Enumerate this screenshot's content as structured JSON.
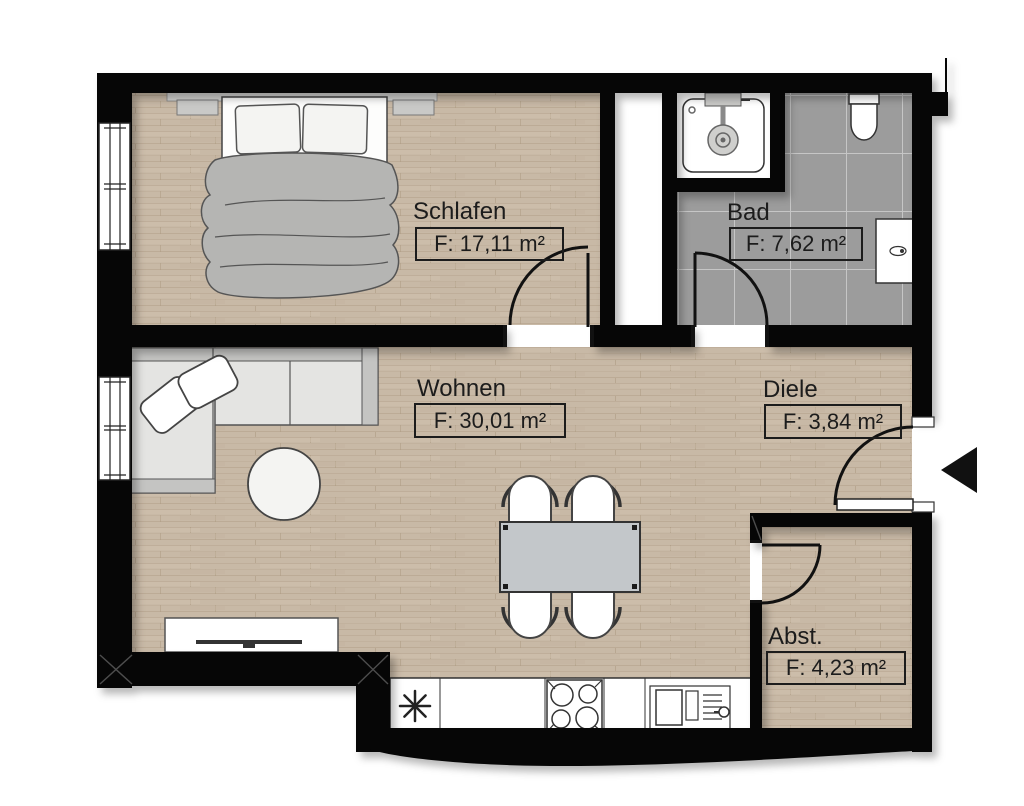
{
  "plan_type": "apartment-floor-plan",
  "rooms": [
    {
      "name": "Schlafen",
      "area_label": "F: 17,11 m²"
    },
    {
      "name": "Bad",
      "area_label": "F: 7,62 m²"
    },
    {
      "name": "Wohnen",
      "area_label": "F: 30,01 m²"
    },
    {
      "name": "Diele",
      "area_label": "F: 3,84 m²"
    },
    {
      "name": "Abst.",
      "area_label": "F: 4,23 m²"
    }
  ],
  "icons": {
    "entrance-arrow-icon": "◀",
    "freezer-asterisk-icon": "✳",
    "stove-icon": "4-burner-circles",
    "sink-icon": "basin-with-drainer",
    "shower-icon": "square-tray-with-head",
    "toilet-icon": "wall-hung-wc",
    "radiator-icon": "white-panel",
    "bed-icon": "double-bed-with-blanket",
    "sofa-icon": "l-shaped-corner-sofa",
    "coffee-table-icon": "round-table",
    "dining-table-icon": "table-with-4-chairs",
    "tv-sideboard-icon": "lowboard-with-tv",
    "door-swing-icon": "quarter-arc",
    "window-icon": "double-line-glazing"
  },
  "colors": {
    "wall": "#000000",
    "wood_floor": "#c8b9a6",
    "tile_floor": "#9c9c9c",
    "tile_grout": "#c6c6c6",
    "furniture_gray": "#c4c4c2",
    "label_ink": "#1c1c1c"
  }
}
